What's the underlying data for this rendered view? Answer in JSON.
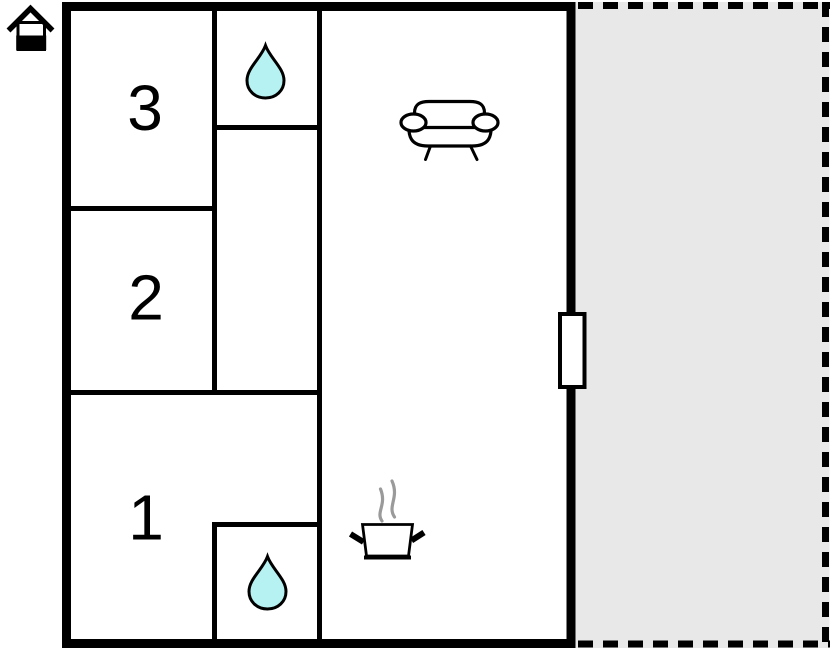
{
  "plan": {
    "type": "floorplan",
    "rooms": [
      {
        "label": "3"
      },
      {
        "label": "2"
      },
      {
        "label": "1"
      }
    ],
    "icons": {
      "logo": "house-icon",
      "bathroom_top": "water-drop-icon",
      "bathroom_bottom": "water-drop-icon",
      "living_room": "sofa-icon",
      "kitchen": "cooking-pot-steam-icon",
      "entrance": "door-symbol"
    },
    "colors": {
      "wall": "#000000",
      "drop_fill": "#b7f2f2",
      "terrace_fill": "#e8e8e8",
      "steam": "#9a9a9a",
      "door_fill": "#ffffff"
    }
  }
}
